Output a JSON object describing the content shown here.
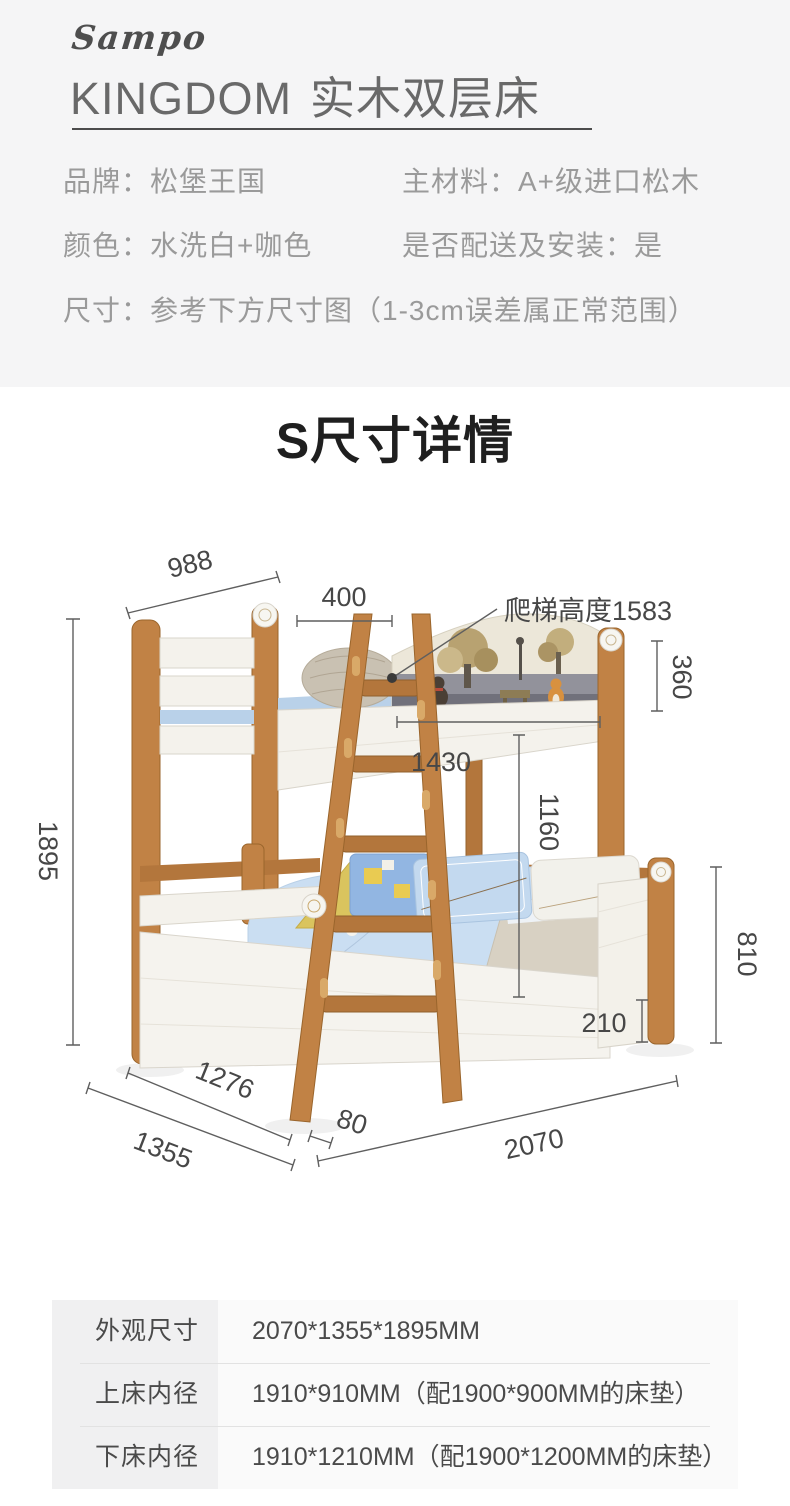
{
  "header": {
    "logo_script": "Sampo",
    "logo_name": "KINGDOM",
    "title": "实木双层床"
  },
  "specs": {
    "brand": "品牌：松堡王国",
    "material": "主材料：A+级进口松木",
    "color": "颜色：水洗白+咖色",
    "delivery": "是否配送及安装：是",
    "size_note": "尺寸：参考下方尺寸图（1-3cm误差属正常范围）"
  },
  "section_title": "S尺寸详情",
  "diagram": {
    "labels": {
      "top_width": "988",
      "ladder_top_width": "400",
      "ladder_note": "爬梯高度1583",
      "headboard_height": "360",
      "inner_length": "1430",
      "under_clearance": "1160",
      "total_height": "1895",
      "lower_height": "810",
      "rail_height": "210",
      "inner_width": "1276",
      "ladder_offset": "80",
      "total_width": "1355",
      "total_length": "2070"
    }
  },
  "size_table": {
    "rows": [
      {
        "label": "外观尺寸",
        "value": "2070*1355*1895MM"
      },
      {
        "label": "上床内径",
        "value": "1910*910MM（配1900*900MM的床垫）"
      },
      {
        "label": "下床内径",
        "value": "1910*1210MM（配1900*1200MM的床垫）"
      }
    ]
  },
  "colors": {
    "background_gray": "#f5f5f6",
    "spec_text_gray": "#9a9a9a",
    "title_dark": "#1f1f1f",
    "wood": "#c18245",
    "board_white": "#f4f2ec",
    "bedding_blue": "#cadef2",
    "dim_line": "#5f5f5f",
    "table_bg": "#fafafa",
    "table_label_bg": "#f0f0f1"
  }
}
